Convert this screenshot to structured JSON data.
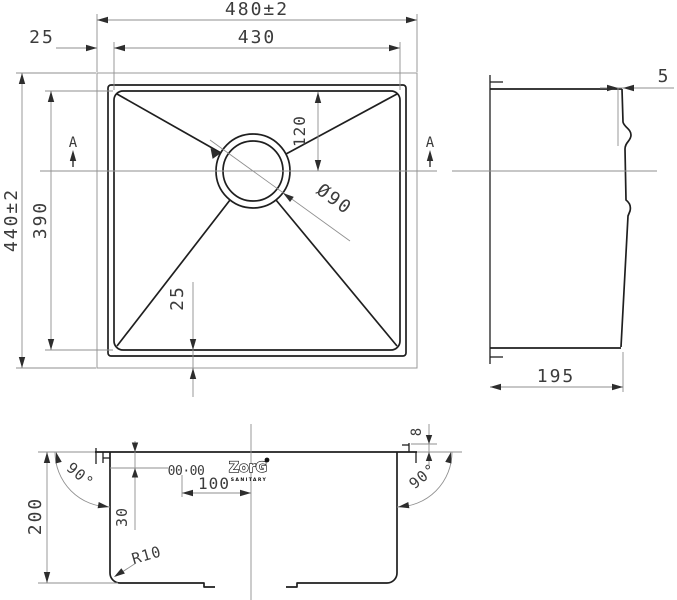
{
  "drawing": {
    "plan": {
      "dim_overall_width": "480±2",
      "dim_inner_width": "430",
      "dim_rim_offset_left": "25",
      "dim_overall_height": "440±2",
      "dim_inner_height": "390",
      "dim_drain_from_top": "120",
      "dim_drain_diameter": "Ø90",
      "dim_rim_offset_bottom": "25",
      "section_marker_left": "A",
      "section_marker_right": "A"
    },
    "side": {
      "dim_rim_lip": "5",
      "dim_depth": "195"
    },
    "section": {
      "dim_height": "200",
      "dim_angle_left": "90°",
      "dim_angle_right": "90°",
      "dim_rim_height": "8",
      "dim_overflow_drop": "30",
      "dim_hole_offset": "100",
      "dim_corner_radius": "R10",
      "marking": "00·00",
      "brand": "ZorG",
      "brand_sub": "SANITARY"
    }
  }
}
